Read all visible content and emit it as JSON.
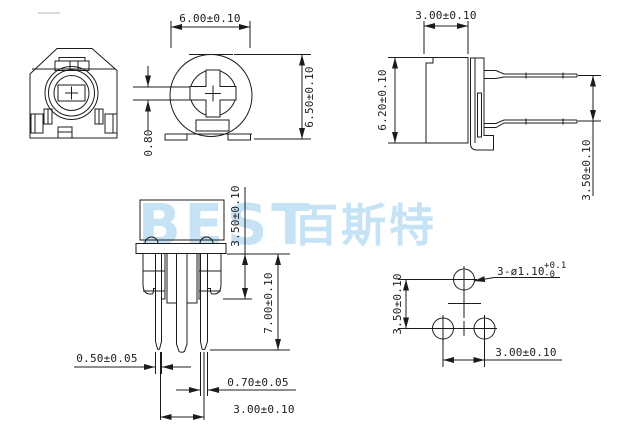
{
  "watermark": {
    "latin": "BEST",
    "cjk": "百斯特",
    "color": "#c6e2f5"
  },
  "colors": {
    "line": "#1c1c1c",
    "background": "#ffffff"
  },
  "dimensions": {
    "top_view": {
      "width": "6.00±0.10",
      "height": "6.50±0.10",
      "slot_width": "0.80"
    },
    "side_view": {
      "body_width": "3.00±0.10",
      "body_height": "6.20±0.10",
      "pin_pitch": "3.50±0.10"
    },
    "front_view": {
      "body_height": "3.50±0.10",
      "pin_length": "7.00±0.10",
      "outer_pin_width": "0.50±0.05",
      "center_pin_width": "0.70±0.05",
      "pin_spacing": "3.00±0.10"
    },
    "pcb_pattern": {
      "hole_callout": "3-ø1.10",
      "hole_tol_upper": "+0.1",
      "hole_tol_lower": "-0",
      "row_pitch": "3.50±0.10",
      "hole_pitch": "3.00±0.10"
    }
  }
}
